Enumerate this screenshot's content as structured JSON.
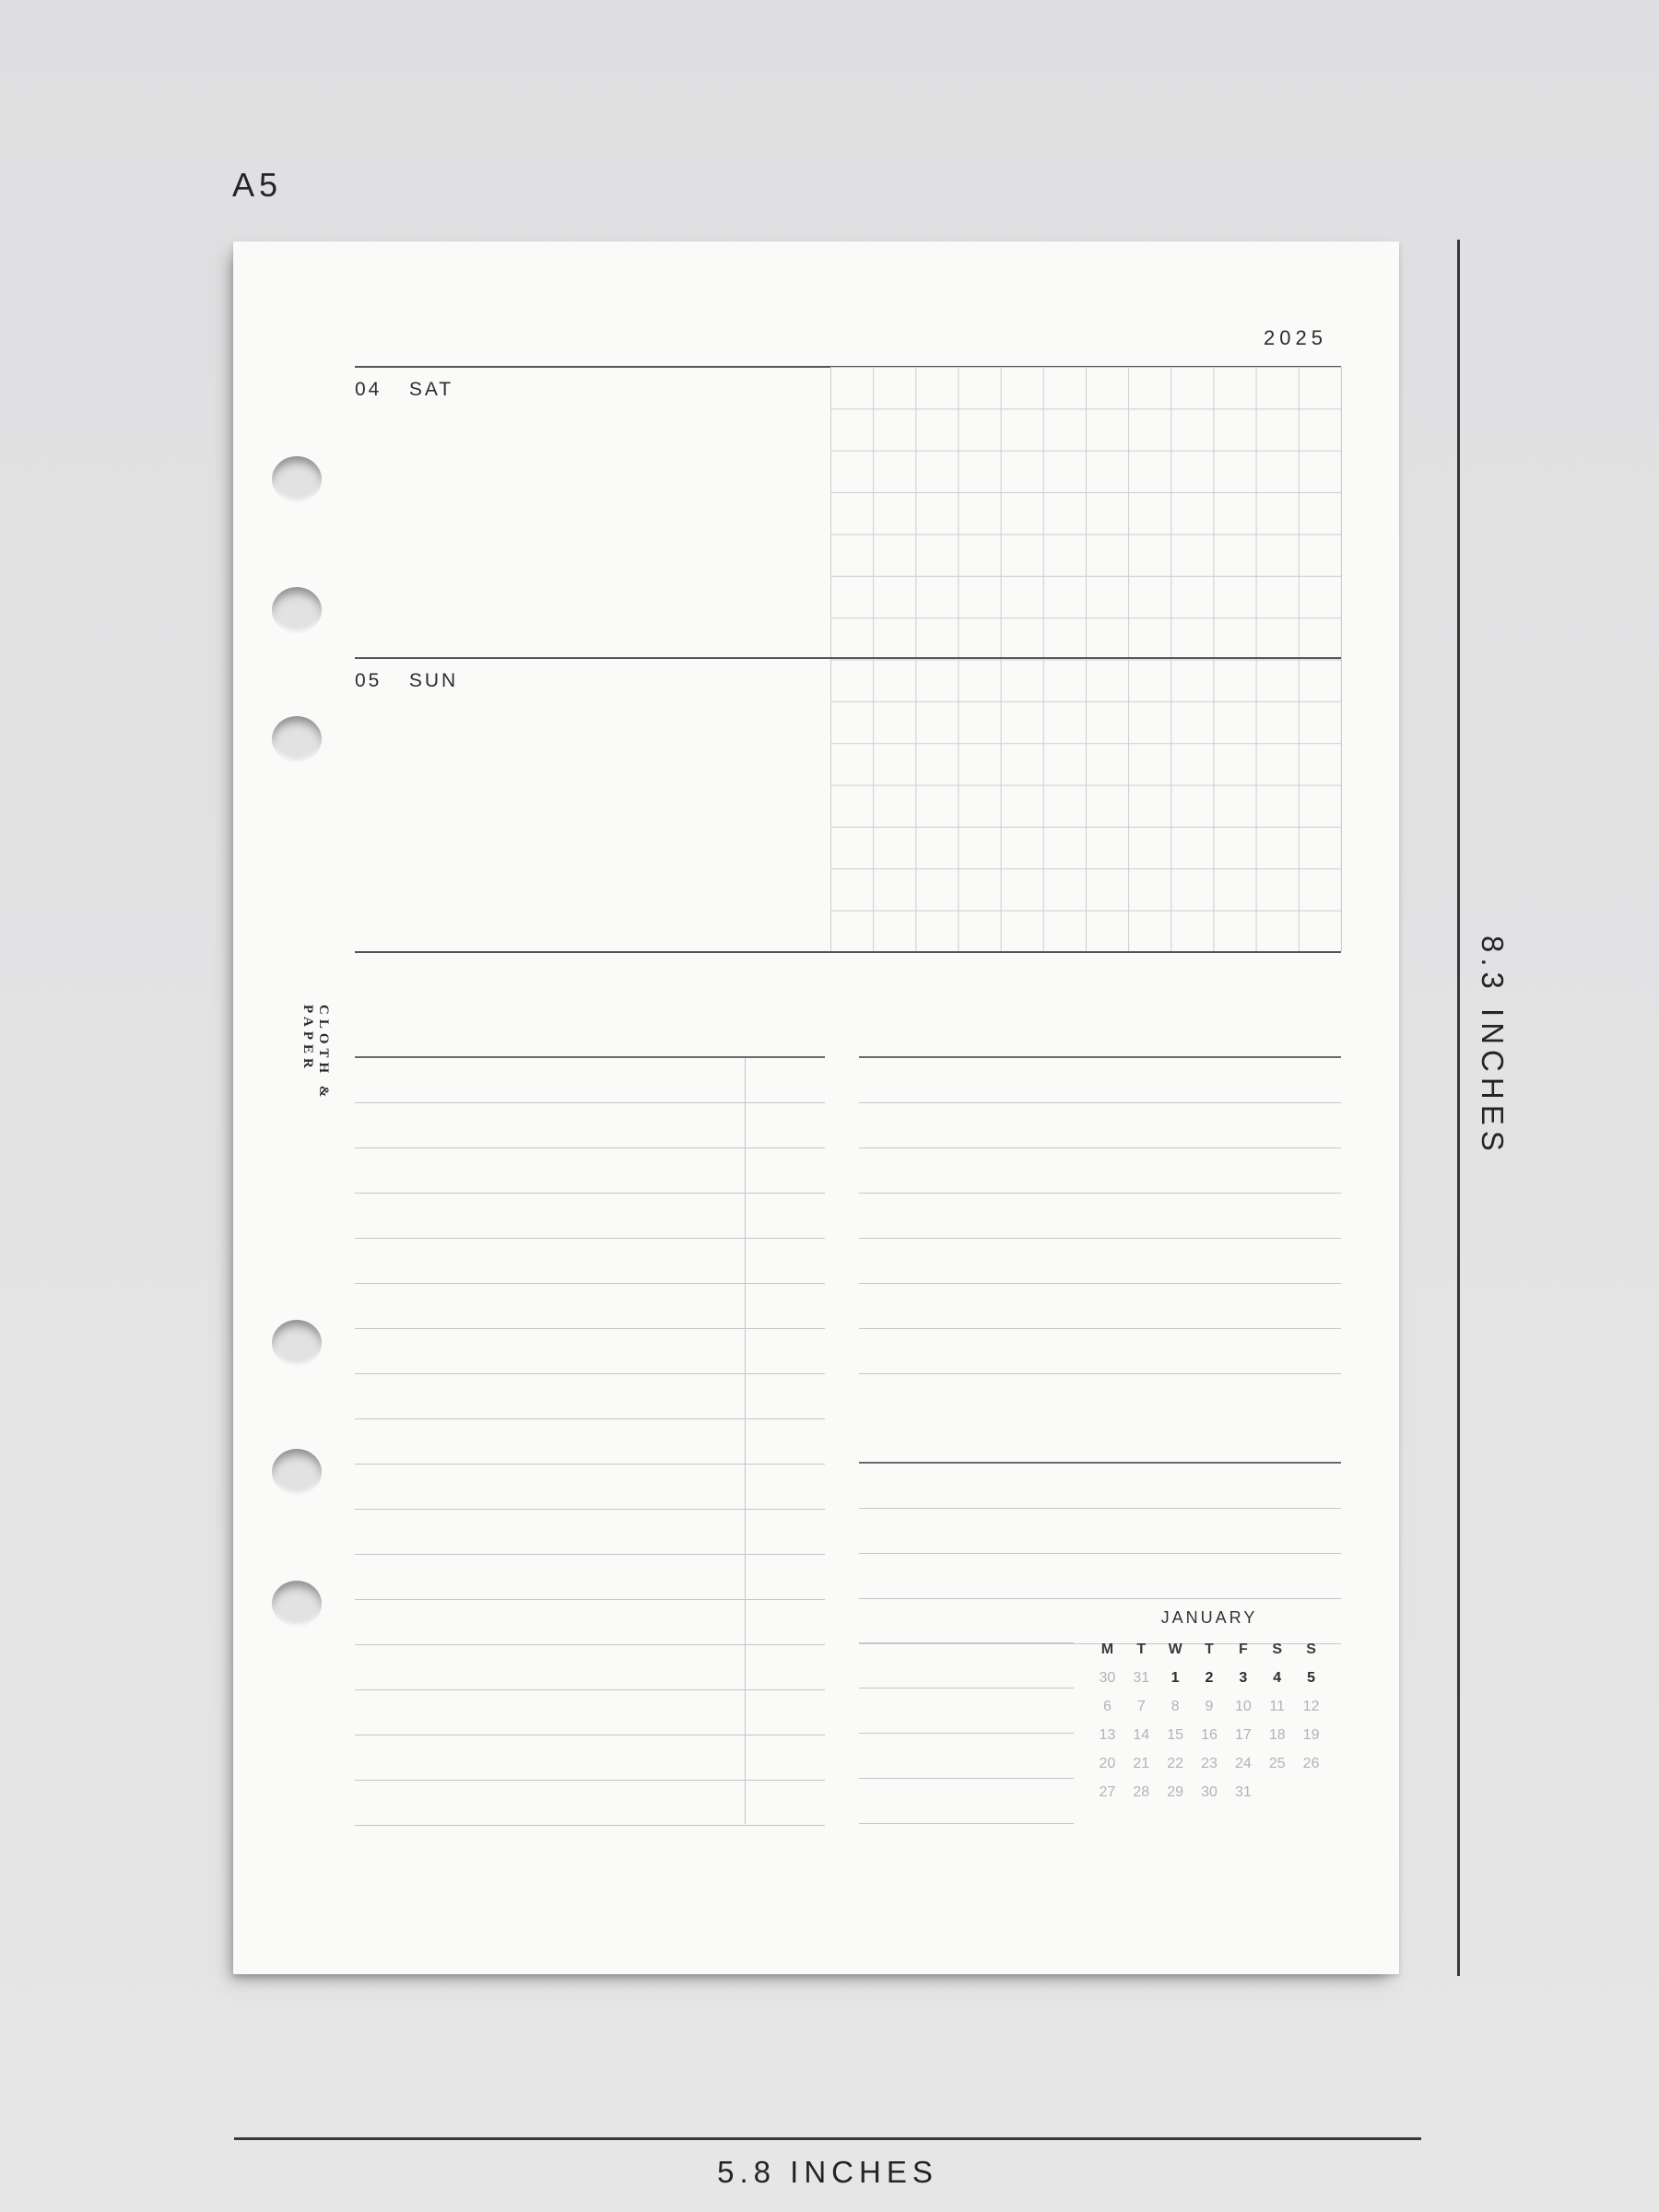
{
  "labels": {
    "size": "A5",
    "width": "5.8 INCHES",
    "height": "8.3 INCHES"
  },
  "page": {
    "year": "2025",
    "brand": "CLOTH & PAPER",
    "days": [
      {
        "number": "04",
        "name": "SAT"
      },
      {
        "number": "05",
        "name": "SUN"
      }
    ],
    "mini_calendar": {
      "month": "JANUARY",
      "weekday_headers": [
        "M",
        "T",
        "W",
        "T",
        "F",
        "S",
        "S"
      ],
      "weeks": [
        [
          "30",
          "31",
          "1",
          "2",
          "3",
          "4",
          "5"
        ],
        [
          "6",
          "7",
          "8",
          "9",
          "10",
          "11",
          "12"
        ],
        [
          "13",
          "14",
          "15",
          "16",
          "17",
          "18",
          "19"
        ],
        [
          "20",
          "21",
          "22",
          "23",
          "24",
          "25",
          "26"
        ],
        [
          "27",
          "28",
          "29",
          "30",
          "31",
          "",
          ""
        ]
      ],
      "current_week_dates": [
        "1",
        "2",
        "3",
        "4",
        "5"
      ],
      "muted_overflow_dates": [
        "30",
        "31"
      ]
    }
  },
  "colors": {
    "backdrop": "#e3e3e4",
    "paper": "#fafaf9",
    "rule_dark": "#545456",
    "rule_light": "#c6c6c8",
    "text": "#2d2d2f",
    "muted_date": "#b3b3b6",
    "dimension_line": "#39393c"
  }
}
